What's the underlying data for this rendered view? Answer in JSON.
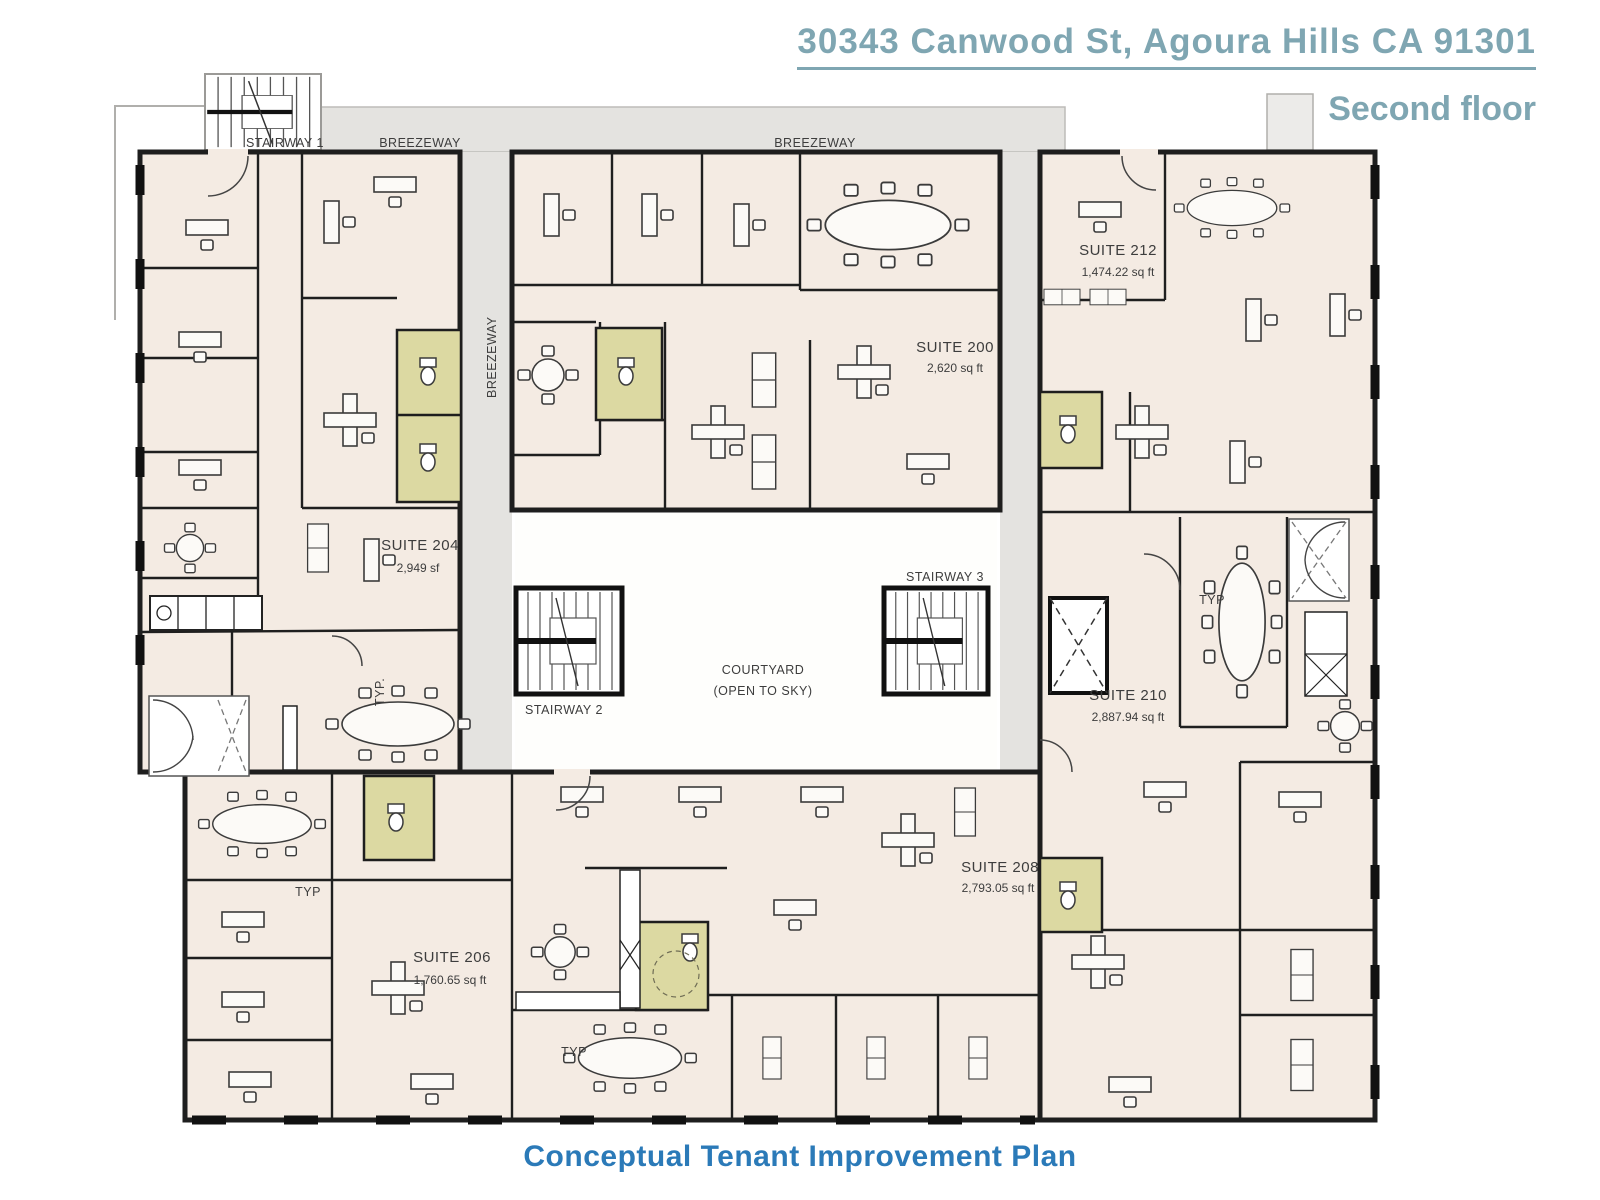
{
  "header": {
    "address": "30343 Canwood St, Agoura Hills  CA 91301",
    "floor": "Second floor"
  },
  "caption": "Conceptual Tenant Improvement Plan",
  "colors": {
    "title_teal": "#7fa6b2",
    "caption_blue": "#2b7ab8",
    "floor_fill": "#f4ebe3",
    "breezeway_gray": "#e4e3e0",
    "restroom_yellow": "#dcd9a2",
    "wall_black": "#1e1e1e"
  },
  "labels": {
    "stairway1": "STAIRWAY 1",
    "stairway2": "STAIRWAY 2",
    "stairway3": "STAIRWAY 3",
    "breezeway_top_left": "BREEZEWAY",
    "breezeway_top_right": "BREEZEWAY",
    "breezeway_vertical": "BREEZEWAY",
    "courtyard_line1": "COURTYARD",
    "courtyard_line2": "(OPEN TO SKY)",
    "typ_left": "TYP.",
    "typ_right": "TYP",
    "typ_bottom_left": "TYP",
    "typ_bottom_center": "TYP"
  },
  "suites": [
    {
      "name": "SUITE 200",
      "area": "2,620 sq ft"
    },
    {
      "name": "SUITE 204",
      "area": "2,949 sf"
    },
    {
      "name": "SUITE 206",
      "area": "1,760.65 sq ft"
    },
    {
      "name": "SUITE 208",
      "area": "2,793.05 sq ft"
    },
    {
      "name": "SUITE 210",
      "area": "2,887.94 sq ft"
    },
    {
      "name": "SUITE 212",
      "area": "1,474.22 sq ft"
    }
  ]
}
